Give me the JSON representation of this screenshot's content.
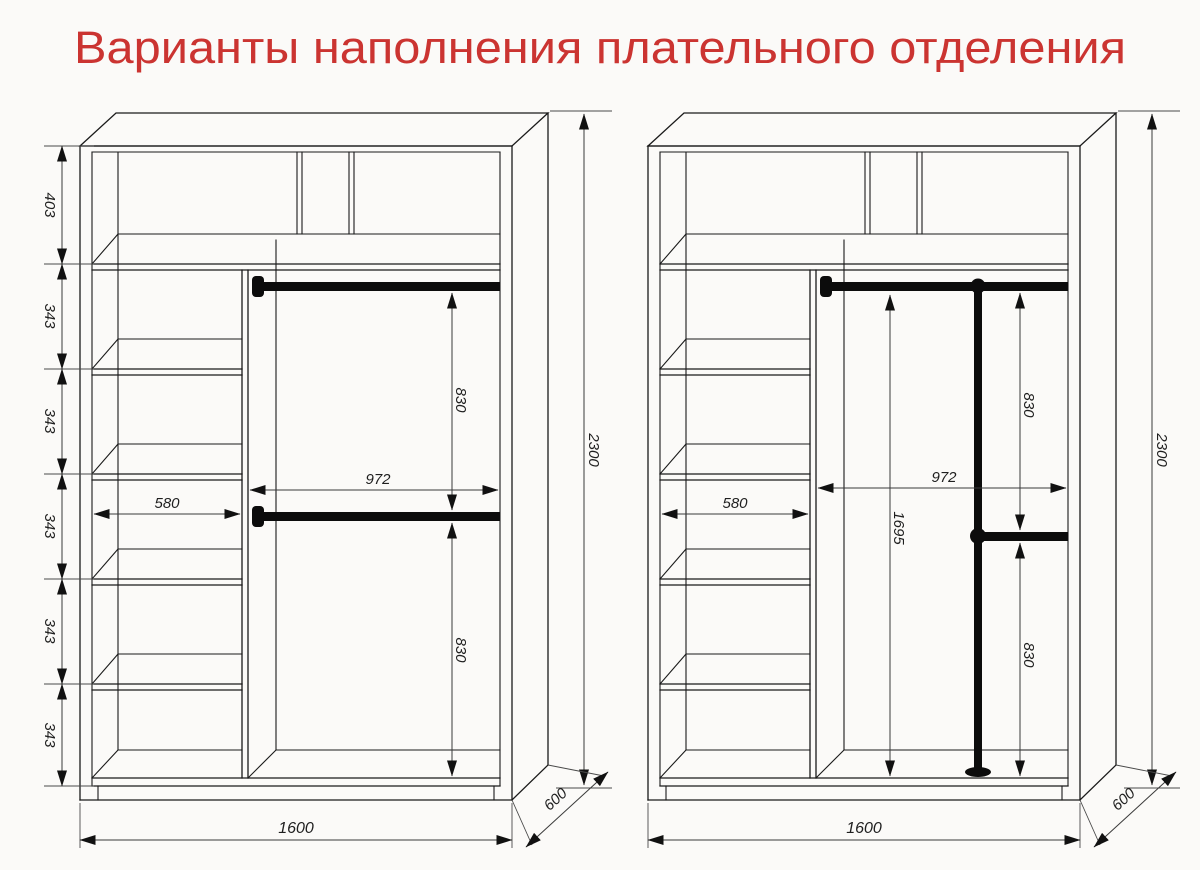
{
  "title": {
    "text": "Варианты наполнения плательного отделения",
    "color": "#cb3431"
  },
  "left_wardrobe": {
    "height_sections": [
      "403",
      "343",
      "343",
      "343",
      "343",
      "343"
    ],
    "shelf_width": "580",
    "hanging_width": "972",
    "upper_rod_to_lower_rod": "830",
    "lower_rod_to_floor": "830",
    "total_width": "1600",
    "depth": "600",
    "total_height": "2300"
  },
  "right_wardrobe": {
    "shelf_width": "580",
    "hanging_width": "972",
    "upper_rod_to_lower_rod": "830",
    "long_hang_height": "1695",
    "lower_rod_to_floor": "830",
    "total_width": "1600",
    "depth": "600",
    "total_height": "2300"
  }
}
